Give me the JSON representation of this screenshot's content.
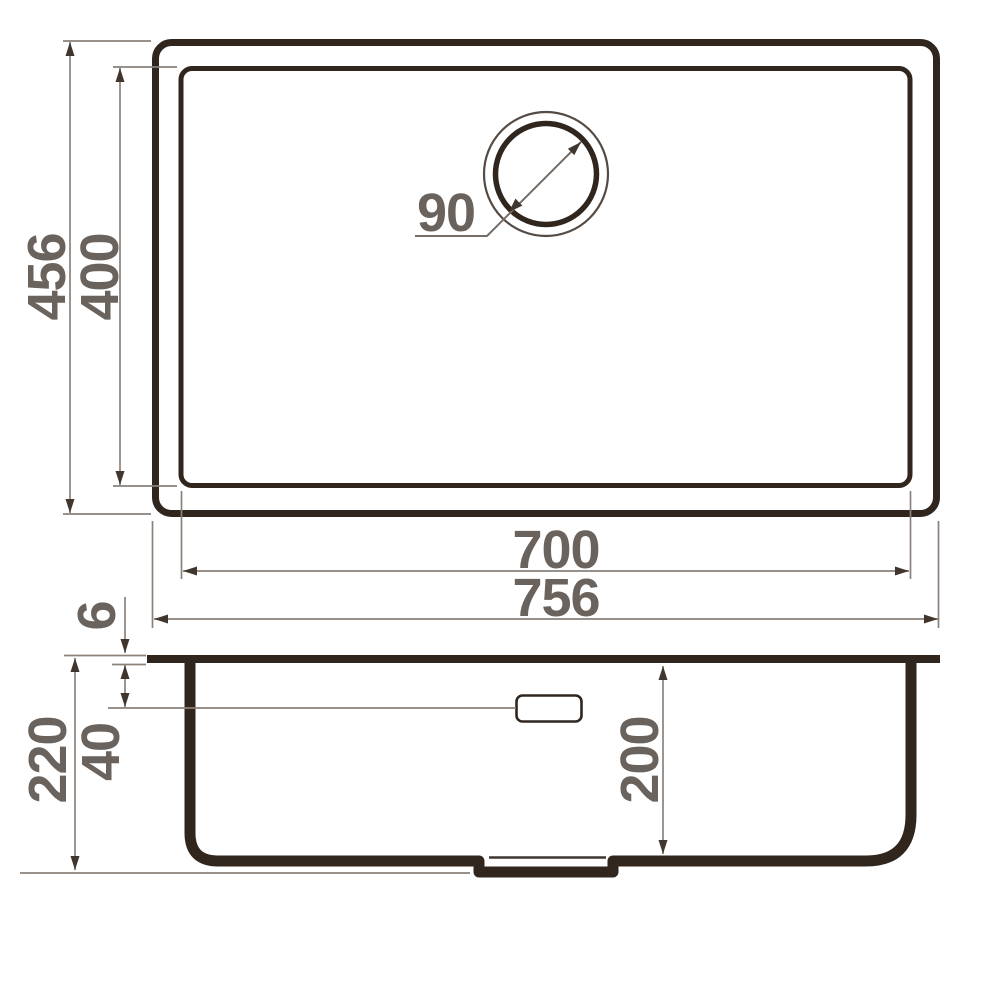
{
  "drawing": {
    "subject": "undermount-sink-dimension-drawing",
    "views": {
      "top_view": "plan view of sink with bowl and round drain",
      "side_view": "section view of sink bowl with overflow and drain recess"
    },
    "dimensions": {
      "overall_depth": "456",
      "bowl_depth": "400",
      "drain_diameter": "90",
      "bowl_width": "700",
      "overall_width": "756",
      "rim_thickness": "6",
      "overflow_offset": "40",
      "overall_height": "220",
      "bowl_height": "200"
    },
    "colors": {
      "outline": "#31261e",
      "dimension_line": "#8a817a",
      "arrow": "#41362d",
      "label_text": "#6a625d",
      "background": "#ffffff"
    }
  }
}
